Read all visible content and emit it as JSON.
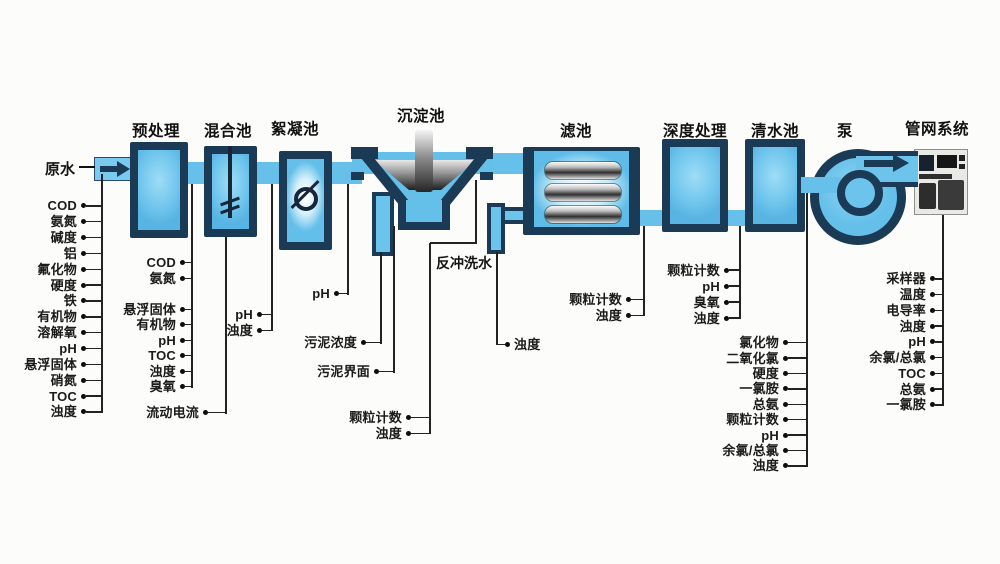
{
  "diagram": {
    "source_label": "原水",
    "backwash_label": "反冲洗水",
    "stages": [
      {
        "id": "pretreatment",
        "title": "预处理"
      },
      {
        "id": "mixing",
        "title": "混合池"
      },
      {
        "id": "flocculation",
        "title": "絮凝池"
      },
      {
        "id": "sedimentation",
        "title": "沉淀池"
      },
      {
        "id": "filter",
        "title": "滤池"
      },
      {
        "id": "advanced",
        "title": "深度处理"
      },
      {
        "id": "clearwell",
        "title": "清水池"
      },
      {
        "id": "pump",
        "title": "泵"
      },
      {
        "id": "network",
        "title": "管网系统"
      }
    ],
    "monitoring": {
      "raw_water": [
        "COD",
        "氨氮",
        "碱度",
        "铝",
        "氟化物",
        "硬度",
        "铁",
        "有机物",
        "溶解氧",
        "pH",
        "悬浮固体",
        "硝氮",
        "TOC",
        "浊度"
      ],
      "pretreatment": [
        "COD",
        "氨氮",
        "悬浮固体",
        "有机物",
        "pH",
        "TOC",
        "浊度",
        "臭氧"
      ],
      "mixing": [
        "流动电流"
      ],
      "mixing_outlet": [
        "pH",
        "浊度"
      ],
      "flocculation_outlet": [
        "pH"
      ],
      "sedimentation_sludge": [
        "污泥浓度",
        "污泥界面"
      ],
      "sedimentation_outlet": [
        "颗粒计数",
        "浊度"
      ],
      "backwash": [
        "浊度"
      ],
      "filter_outlet": [
        "颗粒计数",
        "浊度"
      ],
      "advanced_outlet": [
        "颗粒计数",
        "pH",
        "臭氧",
        "浊度"
      ],
      "clearwell_outlet": [
        "氯化物",
        "二氧化氯",
        "硬度",
        "一氯胺",
        "总氨",
        "颗粒计数",
        "pH",
        "余氯/总氯",
        "浊度"
      ],
      "network": [
        "采样器",
        "温度",
        "电导率",
        "浊度",
        "pH",
        "余氯/总氯",
        "TOC",
        "总氨",
        "一氯胺"
      ]
    },
    "colors": {
      "tank_border": "#1b3a55",
      "water_fill": "#66c0ea",
      "glow": "#ffffff",
      "line": "#222222",
      "metal_dark": "#2f2f2f",
      "metal_light": "#e8e8e8"
    }
  }
}
